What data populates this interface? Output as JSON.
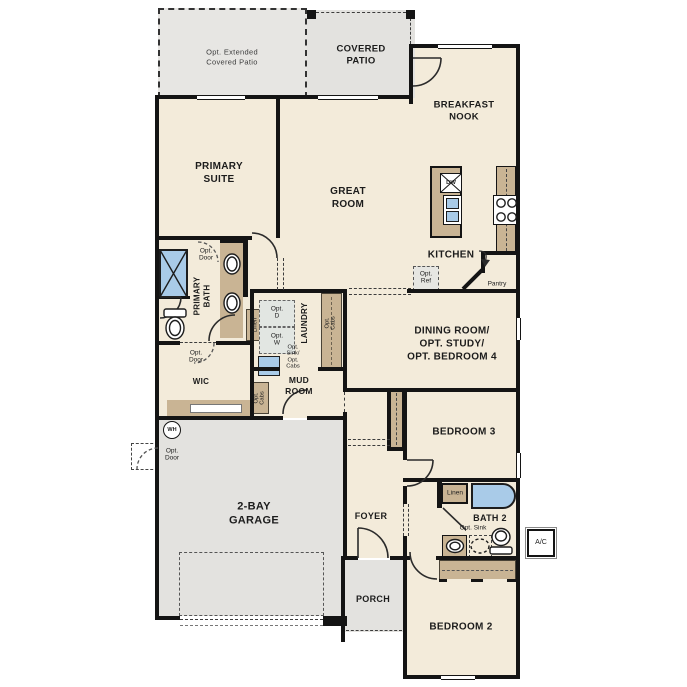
{
  "plan": {
    "type": "residential-floorplan",
    "labels": {
      "opt_extended_patio": "Opt. Extended\nCovered Patio",
      "covered_patio": "COVERED\nPATIO",
      "breakfast_nook": "BREAKFAST\nNOOK",
      "primary_suite": "PRIMARY\nSUITE",
      "great_room": "GREAT\nROOM",
      "kitchen": "KITCHEN",
      "pantry": "Pantry",
      "opt_ref": "Opt.\nRef",
      "dw": "DW",
      "primary_bath": "PRIMARY\nBATH",
      "opt_door": "Opt.\nDoor",
      "linen": "Linen",
      "wic": "WIC",
      "opt_d": "Opt.\nD",
      "opt_w": "Opt.\nW",
      "opt_sink_cabs": "Opt.\nSink/\nOpt.\nCabs",
      "laundry": "LAUNDRY",
      "opt_cabs": "Opt.\nCabs",
      "mud_room": "MUD\nROOM",
      "dining_room": "DINING ROOM/\nOPT. STUDY/\nOPT. BEDROOM 4",
      "bedroom_3": "BEDROOM 3",
      "bath_2": "BATH 2",
      "opt_sink": "Opt. Sink",
      "bedroom_2": "BEDROOM 2",
      "foyer": "FOYER",
      "porch": "PORCH",
      "garage": "2-BAY\nGARAGE",
      "wh": "WH",
      "ac": "A/C"
    },
    "colors": {
      "wall": "#141414",
      "room_fill": "#f3ebda",
      "patio_garage_fill": "#e3e2df",
      "cabinet_tan": "#c9b494",
      "fixture_blue": "#a9cbe8",
      "text": "#1c1c1c"
    }
  }
}
